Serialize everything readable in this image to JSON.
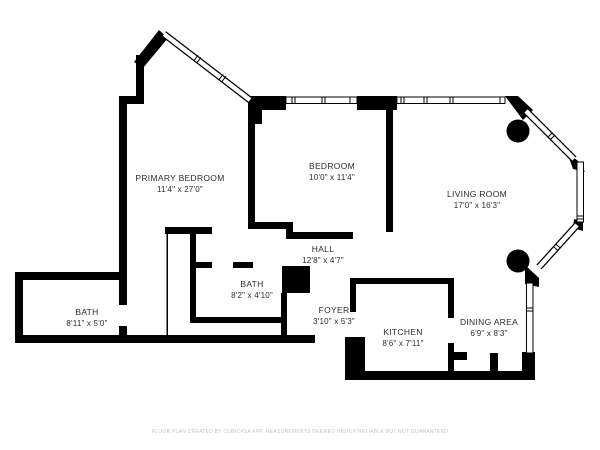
{
  "floor_plan": {
    "wall_color": "#000000",
    "label_color": "#2b2b2b",
    "footer_color": "#c3c3c3",
    "columns_count": 2,
    "rooms": [
      {
        "id": "primary-bedroom",
        "name": "PRIMARY BEDROOM",
        "dimensions": "11'4\" x 27'0\""
      },
      {
        "id": "bedroom",
        "name": "BEDROOM",
        "dimensions": "10'0\" x 11'4\""
      },
      {
        "id": "living-room",
        "name": "LIVING ROOM",
        "dimensions": "17'0\" x 16'3\""
      },
      {
        "id": "hall",
        "name": "HALL",
        "dimensions": "12'8\" x 4'7\""
      },
      {
        "id": "bath-small",
        "name": "BATH",
        "dimensions": "8'2\" x 4'10\""
      },
      {
        "id": "bath-large",
        "name": "BATH",
        "dimensions": "8'11\" x 5'0\""
      },
      {
        "id": "foyer",
        "name": "FOYER",
        "dimensions": "3'10\" x 5'3\""
      },
      {
        "id": "kitchen",
        "name": "KITCHEN",
        "dimensions": "8'6\" x 7'11\""
      },
      {
        "id": "dining-area",
        "name": "DINING AREA",
        "dimensions": "6'9\" x 8'3\""
      }
    ]
  },
  "footer": {
    "disclaimer": "FLOOR PLAN CREATED BY CUBICASA APP. MEASUREMENTS DEEMED HIGHLY RELIABLE BUT NOT GUARANTEED"
  }
}
